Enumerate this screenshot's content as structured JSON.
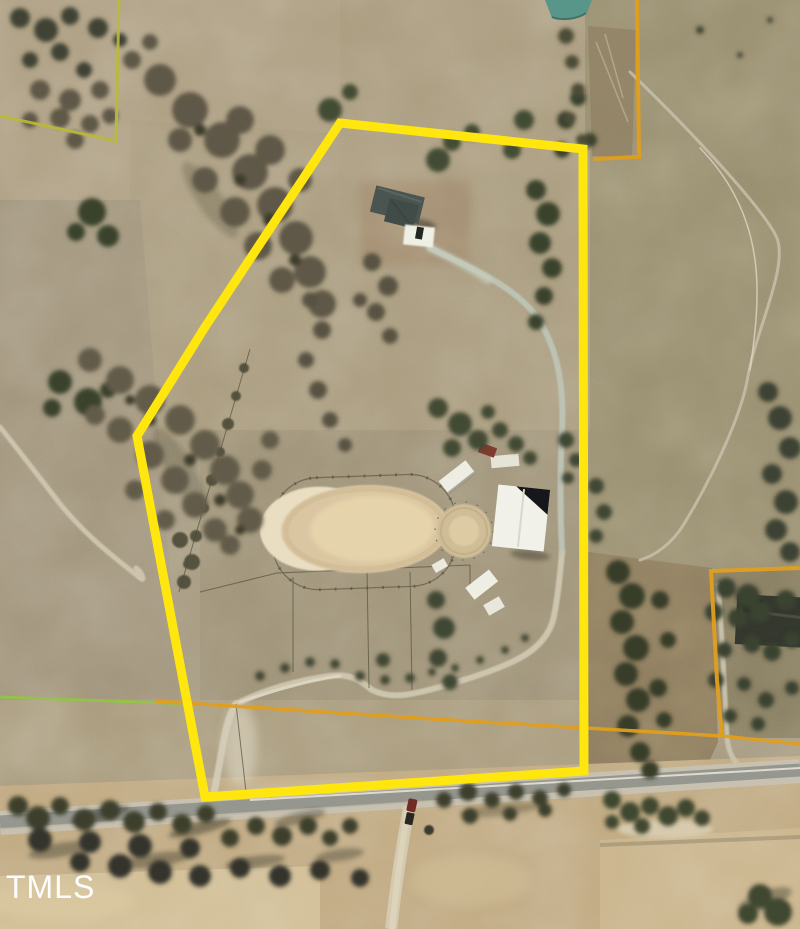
{
  "watermark": {
    "text": "TMLS",
    "color": "#fdfdfd"
  },
  "boundaries": {
    "subject_parcel": {
      "label": "subject-property-boundary",
      "color": "#ffe60d",
      "stroke_width": "9",
      "points": "340,123 583,149 584,771 205,797 137,436 205,327"
    },
    "parcel_top_right": {
      "label": "adjacent-parcel-boundary-top-right",
      "color": "#df9b1c",
      "stroke_width": "4",
      "points": "637,0 639,157 593,159"
    },
    "parcel_right": {
      "label": "adjacent-parcel-boundary-right",
      "color": "#df9b1c",
      "stroke_width": "4",
      "points": "800,568 711,571 717,680 722,736"
    },
    "parcel_right_south_line": {
      "label": "adjacent-parcel-south-line",
      "color": "#df9b1c",
      "stroke_width": "3.5",
      "points": "155,701 433,719 722,736 800,744"
    },
    "parcel_left_green_line": {
      "label": "adjacent-parcel-green-line",
      "color": "#8cc63e",
      "stroke_width": "3",
      "points": "0,697 195,704"
    },
    "parcel_top_left": {
      "label": "adjacent-parcel-boundary-top-left",
      "color": "#b9b832",
      "stroke_width": "3",
      "points": "119,0 116,141 0,116"
    }
  },
  "features": {
    "main_house": "main house",
    "house_pad": "concrete pad",
    "driveway": "driveway",
    "riding_arena": "riding arena",
    "round_pen": "round pen",
    "barn": "barn",
    "run_in_sheds": "run-in sheds",
    "pond": "pond",
    "main_road": "paved road",
    "gravel_road": "gravel road",
    "farm_track": "farm track",
    "vehicle": "vehicle on road",
    "neighbor_house": "neighboring house"
  }
}
